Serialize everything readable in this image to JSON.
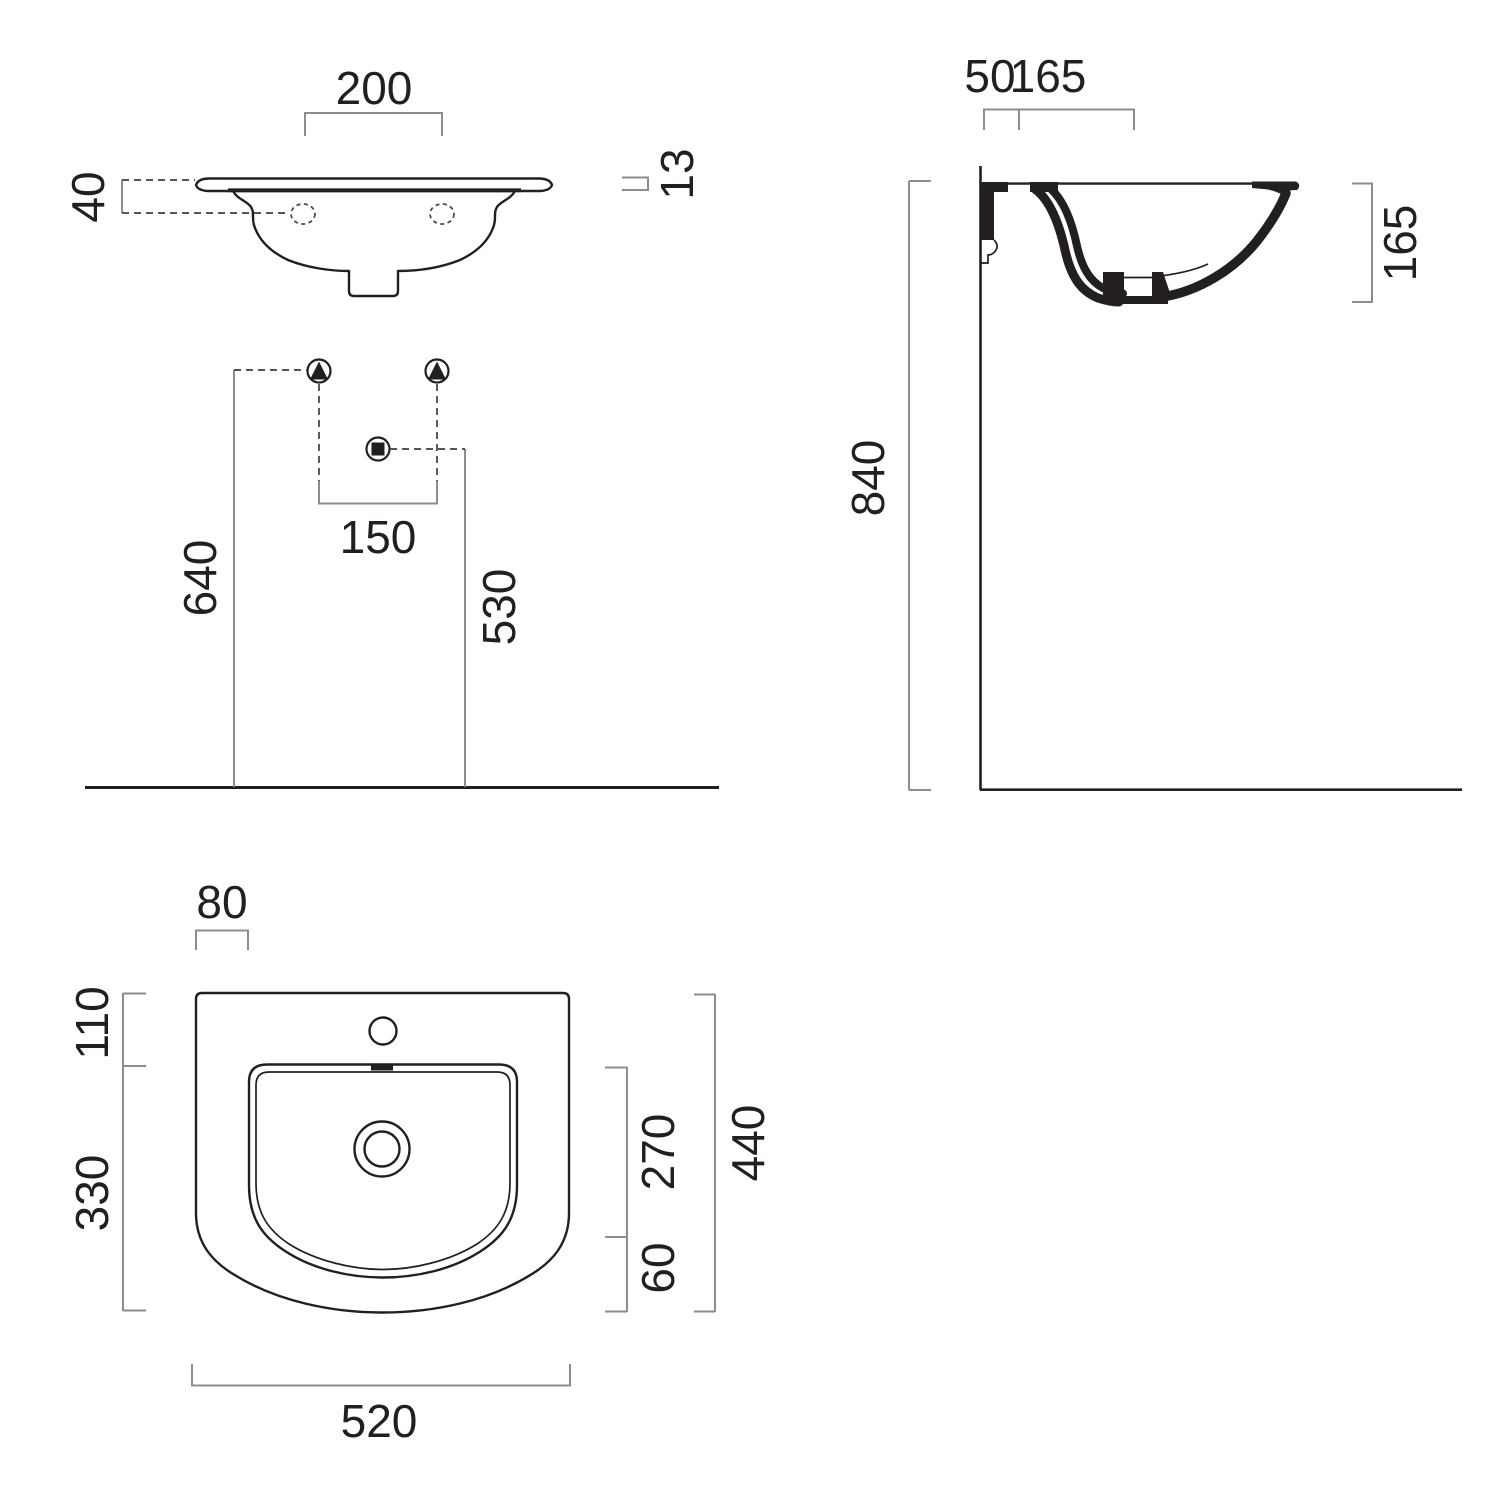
{
  "drawing": {
    "front_view": {
      "tap_hole_centres": "200",
      "holes_below_rim": "40",
      "rim_thickness": "13",
      "supply_centres": "150",
      "supply_height": "640",
      "waste_height": "530"
    },
    "side_view": {
      "wall_to_tap": "50",
      "tap_to_basin": "165",
      "basin_depth": "165",
      "rim_height": "840"
    },
    "plan_view": {
      "rear_deck_depth": "80",
      "deck_to_basin": "110",
      "basin_to_front": "330",
      "basin_inner_depth": "270",
      "front_lip": "60",
      "overall_depth": "440",
      "overall_width": "520"
    },
    "symbols": {
      "water_supply": "triangle-in-circle",
      "waste_outlet": "square-in-circle"
    },
    "colors": {
      "outline": "#231f20",
      "dimension_lines": "#8d8d8d",
      "background": "#ffffff"
    }
  }
}
